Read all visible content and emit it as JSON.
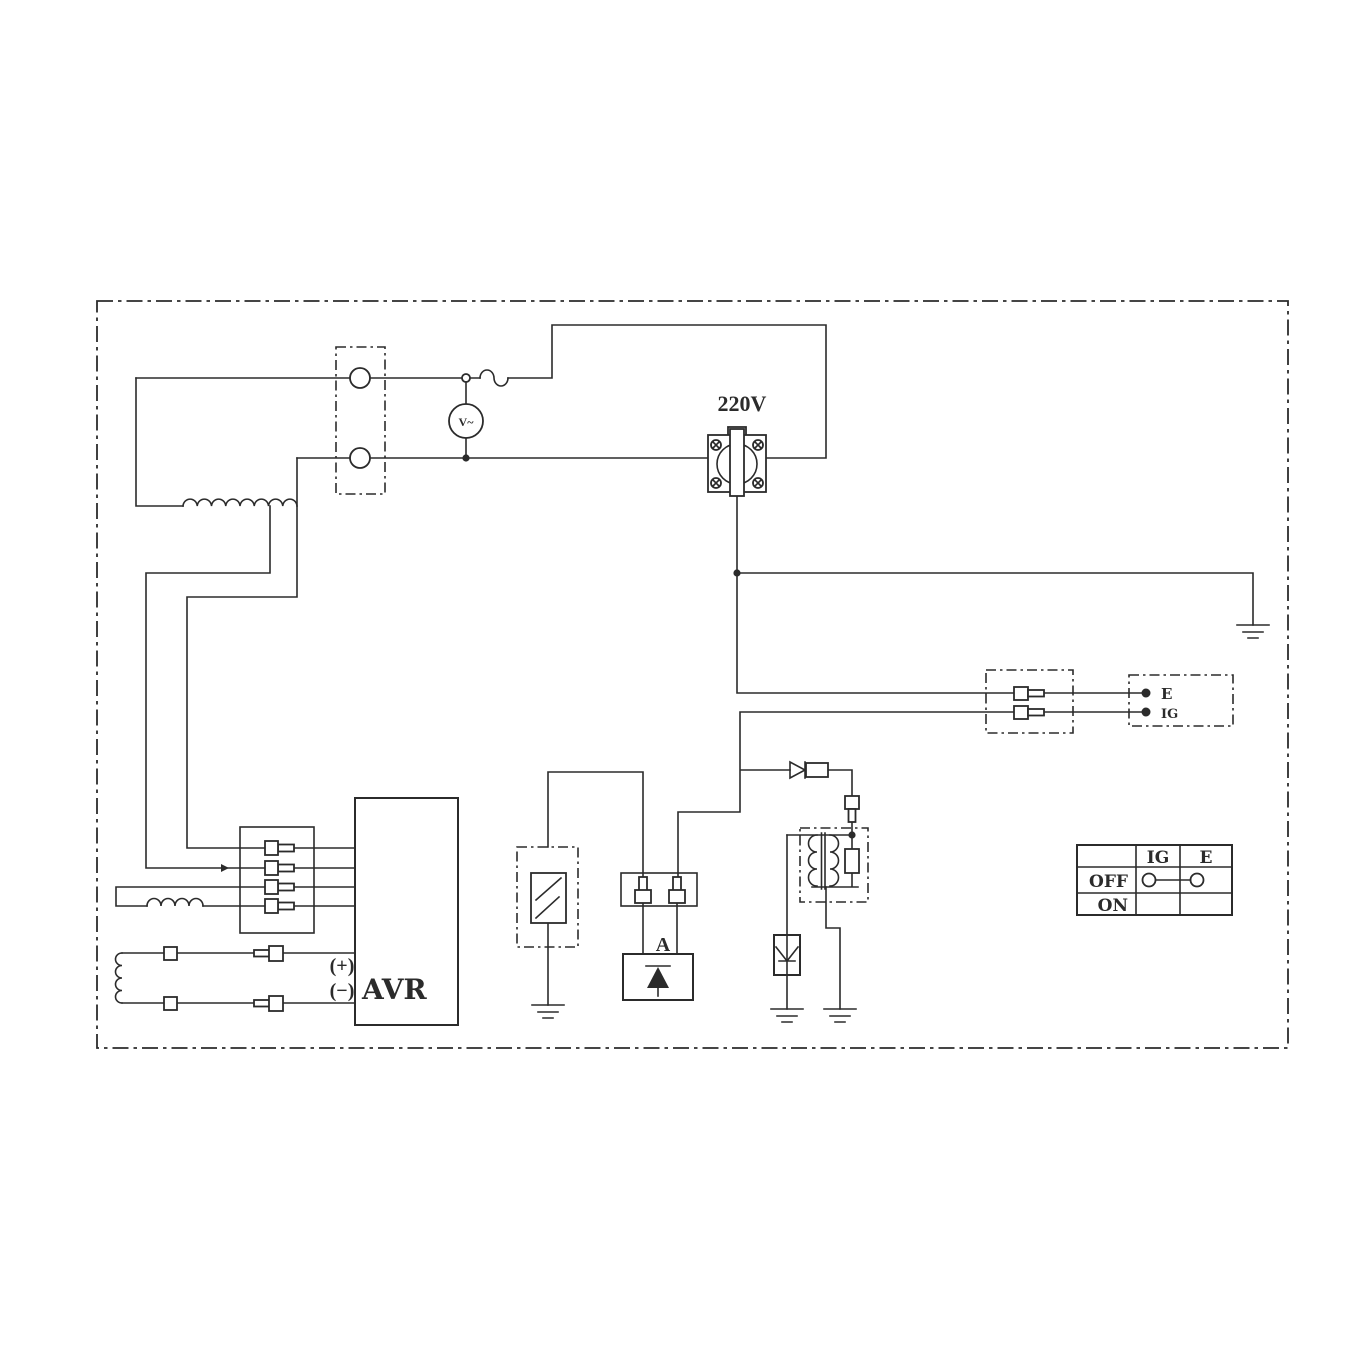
{
  "colors": {
    "line": "#2b2b2b",
    "bg": "#ffffff"
  },
  "labels": {
    "outlet_voltage": "220V",
    "voltmeter": "V~",
    "avr": "AVR",
    "avr_plus": "(+)",
    "avr_minus": "(−)",
    "rectifier_terminal": "A",
    "engine_terminal_e": "E",
    "engine_terminal_ig": "IG"
  },
  "switch_table": {
    "col_ig": "IG",
    "col_e": "E",
    "row_off": "OFF",
    "row_on": "ON"
  }
}
